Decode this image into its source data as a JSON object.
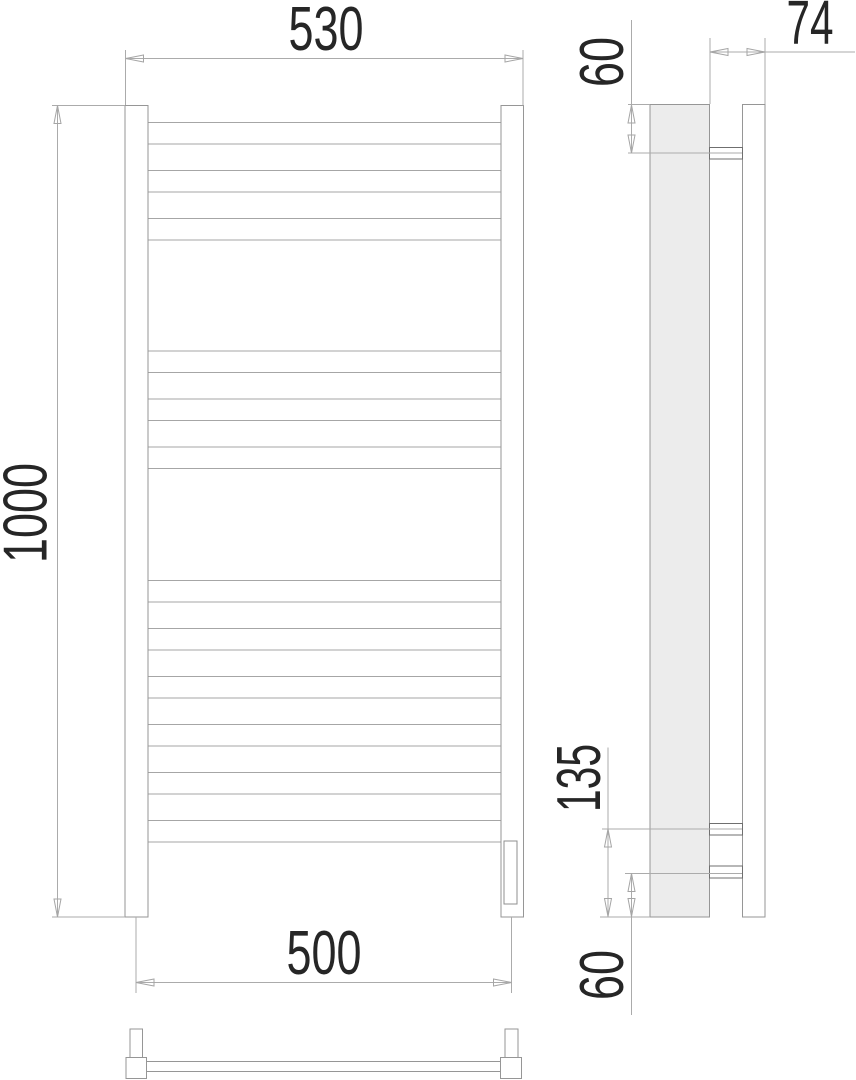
{
  "drawing": {
    "type": "technical-drawing",
    "subject": "ladder towel rail, three views with dimensions"
  },
  "views": {
    "front": {
      "name": "front-view",
      "dim_width_top": "530",
      "dim_height": "1000",
      "dim_width_bottom": "500",
      "tube_groups": [
        3,
        3,
        6
      ],
      "tube_count": 12
    },
    "side": {
      "name": "side-view",
      "dim_top_offset": "60",
      "dim_depth": "74",
      "dim_bracket_span": "135",
      "dim_bottom_offset": "60",
      "bracket_count": 3
    },
    "bottom": {
      "name": "bottom-view"
    }
  },
  "colors": {
    "background": "#ffffff",
    "outline": "#969696",
    "tube_line": "#a6a6a6",
    "dimension_line": "#ababab",
    "dimension_text": "#262626",
    "side_profile_fill": "#ececec",
    "bracket_line": "#6f6f6f"
  }
}
